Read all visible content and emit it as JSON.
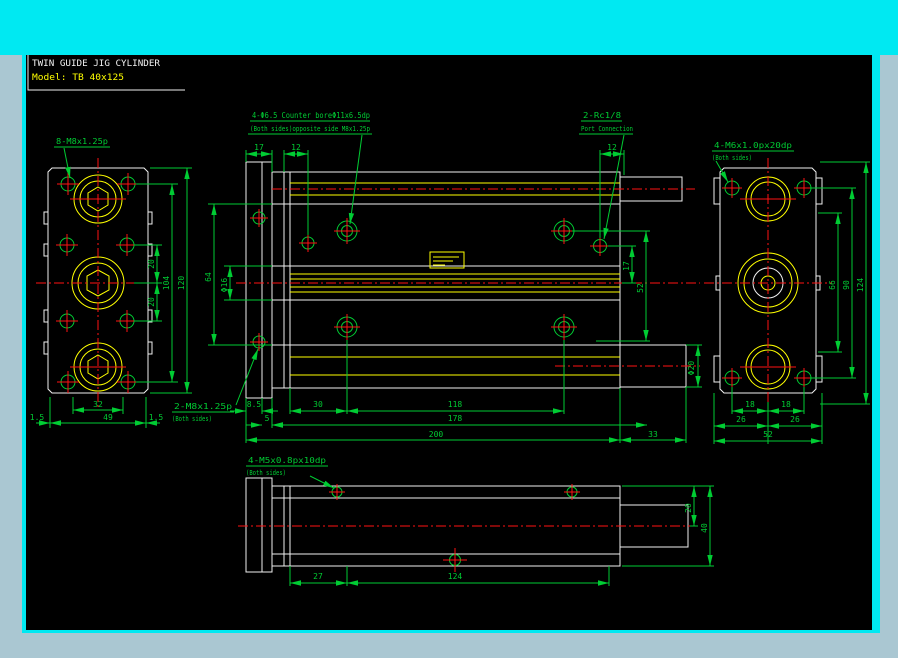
{
  "window": {
    "colors": {
      "frame_top": "#00e9f2",
      "frame_side": "#aac7d2",
      "canvas": "#000000",
      "outline": "#f0f0f0",
      "detail": "#ffff00",
      "dimension": "#00cc33",
      "centerline": "#ff1212"
    }
  },
  "title": {
    "line1": "TWIN GUIDE JIG CYLINDER",
    "line2": "Model: TB 40x125"
  },
  "front_view": {
    "thread_label": "8-M8x1.25p",
    "d20a": "20",
    "d20b": "20",
    "d104": "104",
    "d120": "120",
    "d32": "32",
    "d49": "49",
    "d15l": "1.5",
    "d15r": "1.5"
  },
  "side_view": {
    "counterbore_label1": "4-Φ6.5  Counter boreΦ11x6.5dp",
    "counterbore_label2": "(Both sides)opposite side M8x1.25p",
    "port_label1": "2-Rc1/8",
    "port_label2": "Port Connection",
    "rear_thread_label1": "2-M8x1.25p",
    "rear_thread_label2": "(Both sides)",
    "d17t": "17",
    "d12a": "12",
    "d12b": "12",
    "d64": "64",
    "dphi16": "Φ16",
    "d17r": "17",
    "d52": "52",
    "d85": "8.5",
    "d5": "5",
    "d30": "30",
    "d118": "118",
    "d178": "178",
    "d200": "200",
    "d33": "33",
    "dphi20": "Φ20"
  },
  "rear_view": {
    "thread_label1": "4-M6x1.0px20dp",
    "thread_label2": "(Both sides)",
    "d18a": "18",
    "d18b": "18",
    "d26a": "26",
    "d26b": "26",
    "d52": "52",
    "d66": "66",
    "d90": "90",
    "d124": "124"
  },
  "plan_view": {
    "thread_label1": "4-M5x0.8px10dp",
    "thread_label2": "(Both sides)",
    "d27": "27",
    "d124": "124",
    "d20": "20",
    "d40": "40"
  }
}
